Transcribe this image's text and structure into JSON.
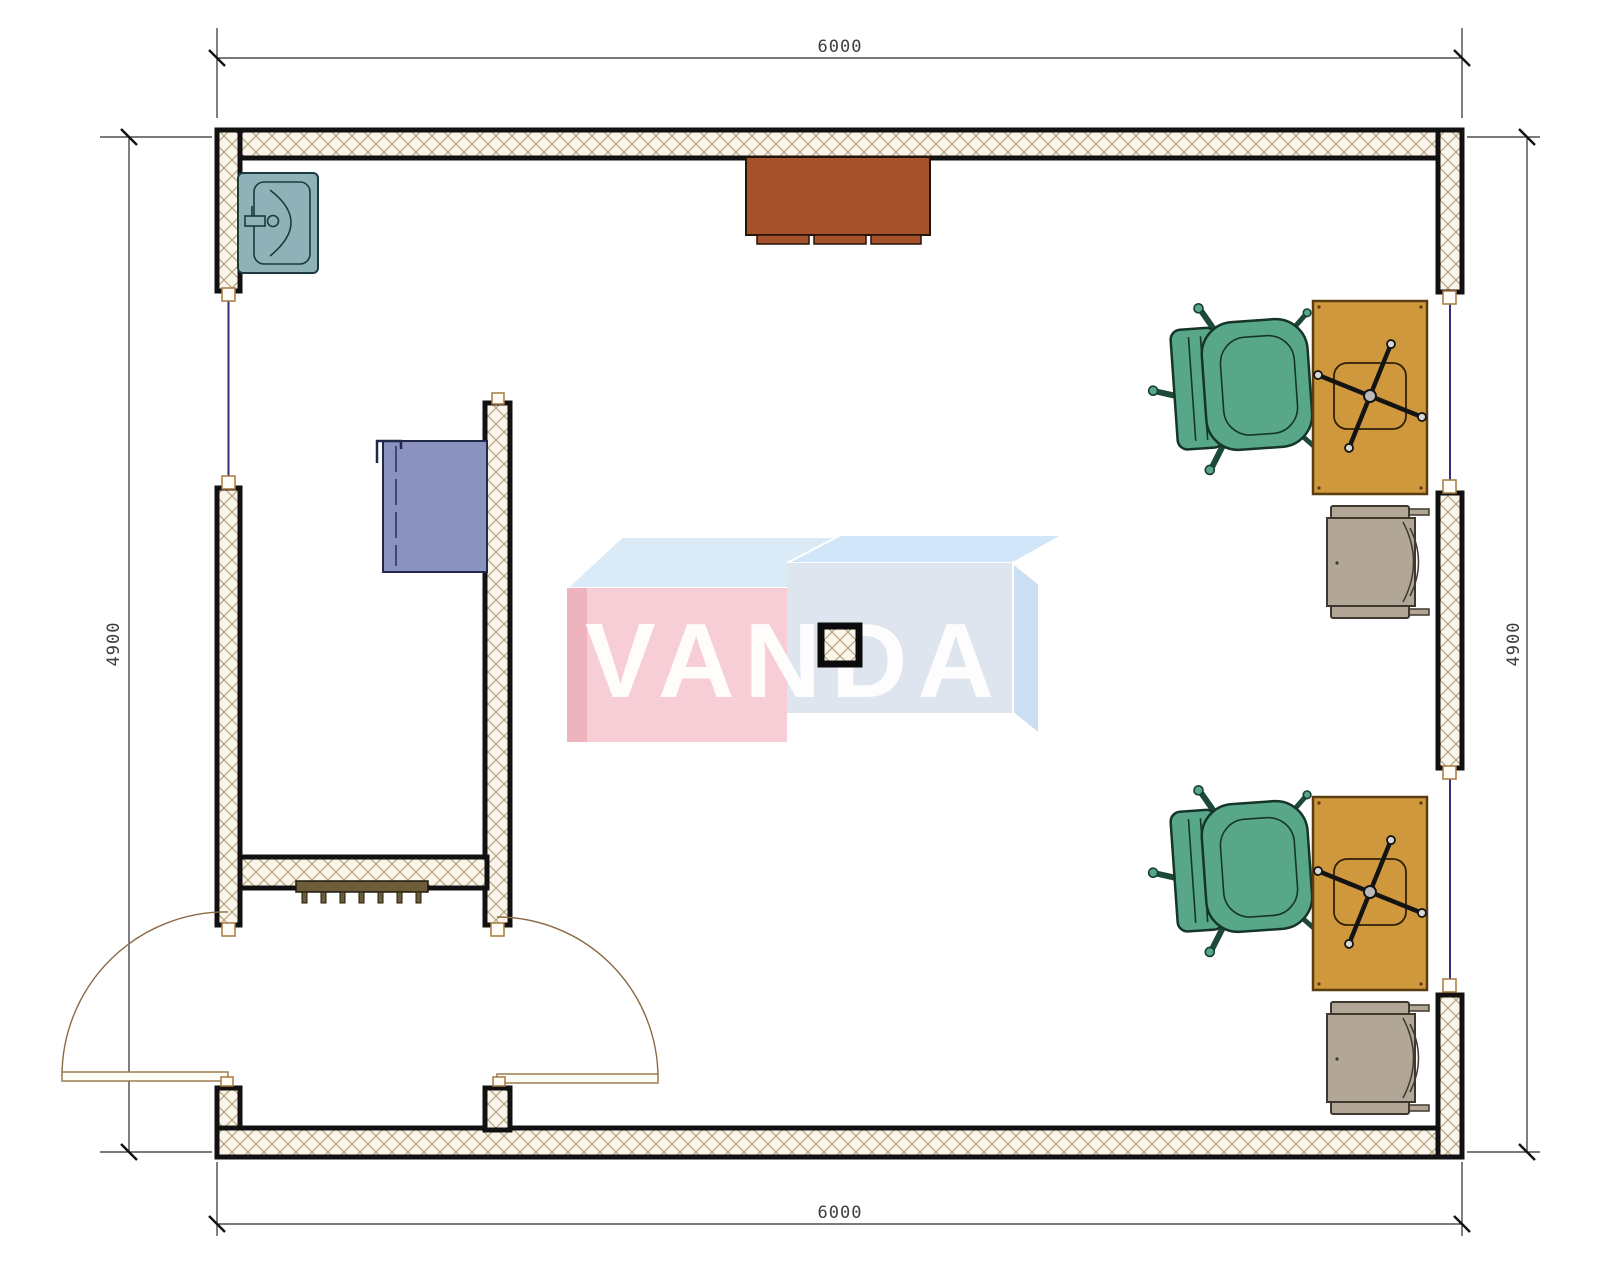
{
  "document": {
    "type": "architectural floor plan",
    "units": "mm"
  },
  "dimensions": {
    "top": "6000",
    "bottom": "6000",
    "left": "4900",
    "right": "4900"
  },
  "watermark": {
    "text": "VANDA"
  },
  "palette": {
    "wall_fill": "#faf5eb",
    "wall_hatch": "#b5a17a",
    "wall_edge": "#111111",
    "window_line": "#2f2f7d",
    "door_arc": "#8a6b45",
    "sill_border": "#a5793f",
    "sink": "#8fb2b8",
    "wall_cabinet": "#a4512c",
    "blue_cabinet": "#8a93bf",
    "radiator": "#6e5d38",
    "desk_orange": "#d0983c",
    "chair_green": "#57a788",
    "chair_gray": "#b2a697",
    "wm_pink_front": "#f8ccd4",
    "wm_pink_side": "#eeafba",
    "wm_blue_top": "#d9e9f7",
    "wm_blue_top2": "#cfe5f8",
    "wm_blue_front": "#dde4ee",
    "wm_blue_side": "#c9def2",
    "dim_text": "#3d3d3d"
  },
  "elements": {
    "rooms": [
      "main room",
      "entry vestibule"
    ],
    "fixtures": [
      "corner sink",
      "wall cabinet",
      "blue cabinet",
      "radiator",
      "structural column"
    ],
    "doors": [
      "double entry door left leaf",
      "double entry door right leaf"
    ],
    "windows": [
      "left wall window",
      "right wall upper window",
      "right wall lower window"
    ],
    "workstations": [
      {
        "chair": "green armchair",
        "desk": "desk with task chair",
        "side_chair": "gray armchair"
      },
      {
        "chair": "green armchair",
        "desk": "desk with task chair",
        "side_chair": "gray armchair"
      }
    ]
  }
}
